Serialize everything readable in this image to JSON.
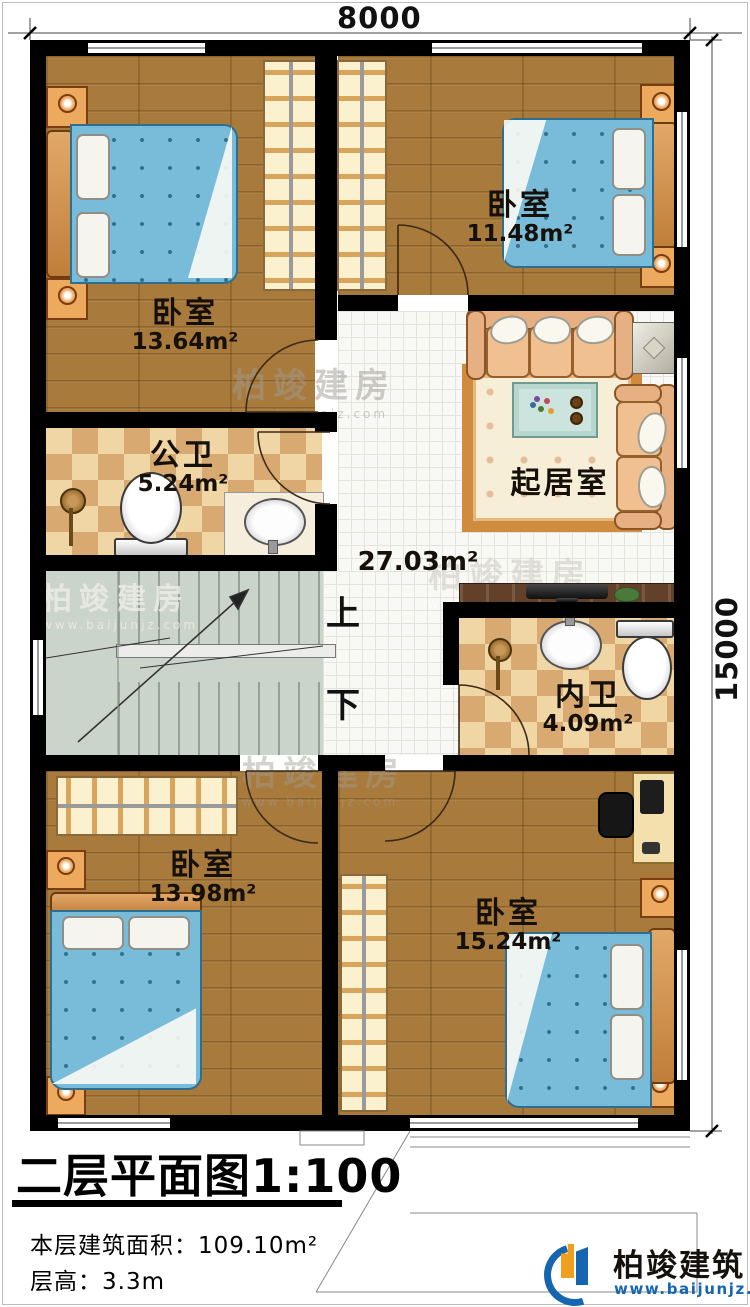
{
  "sheet": {
    "title": "二层平面图",
    "scale": "1:100",
    "area_label": "本层建筑面积：",
    "area_value": "109.10m²",
    "height_label": "层高：",
    "height_value": "3.3m"
  },
  "dimensions": {
    "width_top": "8000",
    "height_right": "15000"
  },
  "rooms": [
    {
      "id": "bedroom-top-left",
      "name": "卧室",
      "area": "13.64m²"
    },
    {
      "id": "bedroom-top-right",
      "name": "卧室",
      "area": "11.48m²"
    },
    {
      "id": "public-bathroom",
      "name": "公卫",
      "area": "5.24m²"
    },
    {
      "id": "living-room",
      "name": "起居室",
      "area": "27.03m²"
    },
    {
      "id": "ensuite-bathroom",
      "name": "内卫",
      "area": "4.09m²"
    },
    {
      "id": "bedroom-bottom-left",
      "name": "卧室",
      "area": "13.98m²"
    },
    {
      "id": "bedroom-bottom-right",
      "name": "卧室",
      "area": "15.24m²"
    }
  ],
  "stairs": {
    "up_label": "上",
    "down_label": "下"
  },
  "brand": {
    "name": "柏竣建筑",
    "website": "www.baijunjz.com"
  },
  "watermark": {
    "text": "柏竣建房",
    "website": "www.baijunjz.com"
  },
  "colors": {
    "wall": "#000000",
    "wood_floor": "#a87a3c",
    "tile_light": "#f0d6a4",
    "tile_dark": "#d8aa72",
    "mattress_blue": "#79bcd9",
    "sofa_tan": "#f0c091",
    "brand_blue": "#1565b0",
    "brand_orange": "#f0a01e"
  }
}
